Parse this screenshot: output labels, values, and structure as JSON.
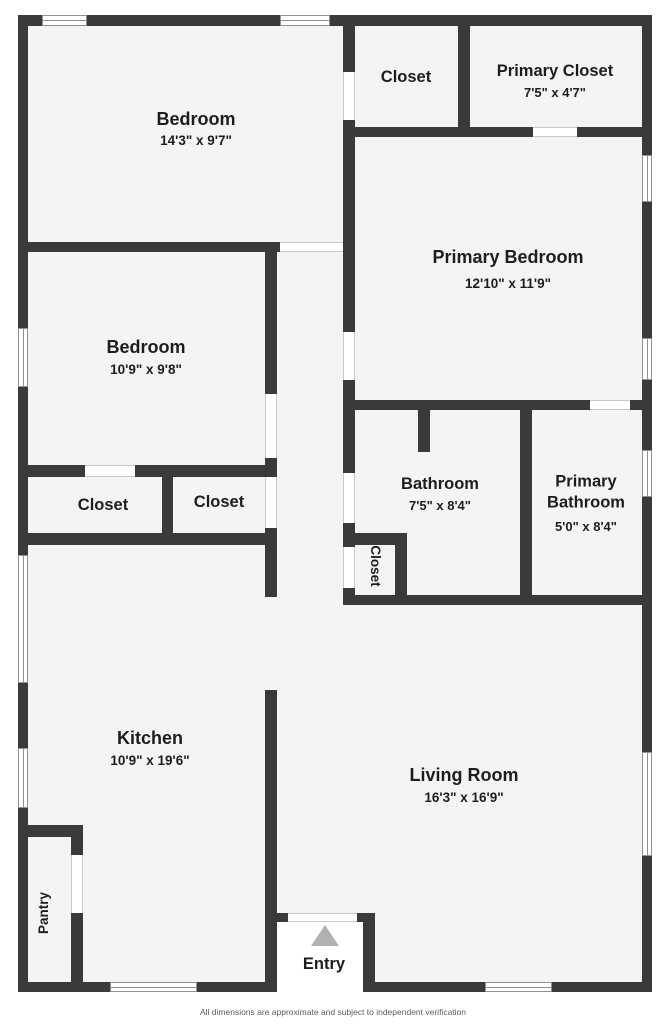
{
  "plan": {
    "rooms": {
      "bedroom1": {
        "name": "Bedroom",
        "dims": "14'3\" x 9'7\""
      },
      "closetTop": {
        "name": "Closet"
      },
      "primaryCloset": {
        "name": "Primary Closet",
        "dims": "7'5\" x 4'7\""
      },
      "primaryBedroom": {
        "name": "Primary Bedroom",
        "dims": "12'10\" x 11'9\""
      },
      "bedroom2": {
        "name": "Bedroom",
        "dims": "10'9\" x 9'8\""
      },
      "closetLeft": {
        "name": "Closet"
      },
      "closetRight": {
        "name": "Closet"
      },
      "bathroom": {
        "name": "Bathroom",
        "dims": "7'5\" x 8'4\""
      },
      "primaryBathroom": {
        "name": "Primary Bathroom",
        "dims": "5'0\" x 8'4\""
      },
      "closetHall": {
        "name": "Closet"
      },
      "kitchen": {
        "name": "Kitchen",
        "dims": "10'9\" x 19'6\""
      },
      "livingRoom": {
        "name": "Living Room",
        "dims": "16'3\" x 16'9\""
      },
      "pantry": {
        "name": "Pantry"
      },
      "entry": {
        "name": "Entry"
      }
    },
    "footer": "All dimensions are approximate and subject to independent verification",
    "colors": {
      "wall": "#3a3a3a",
      "floor": "#f4f4f4",
      "background": "#ffffff",
      "entry_arrow": "#b1b1b1",
      "label_text": "#1d1d1d"
    }
  }
}
